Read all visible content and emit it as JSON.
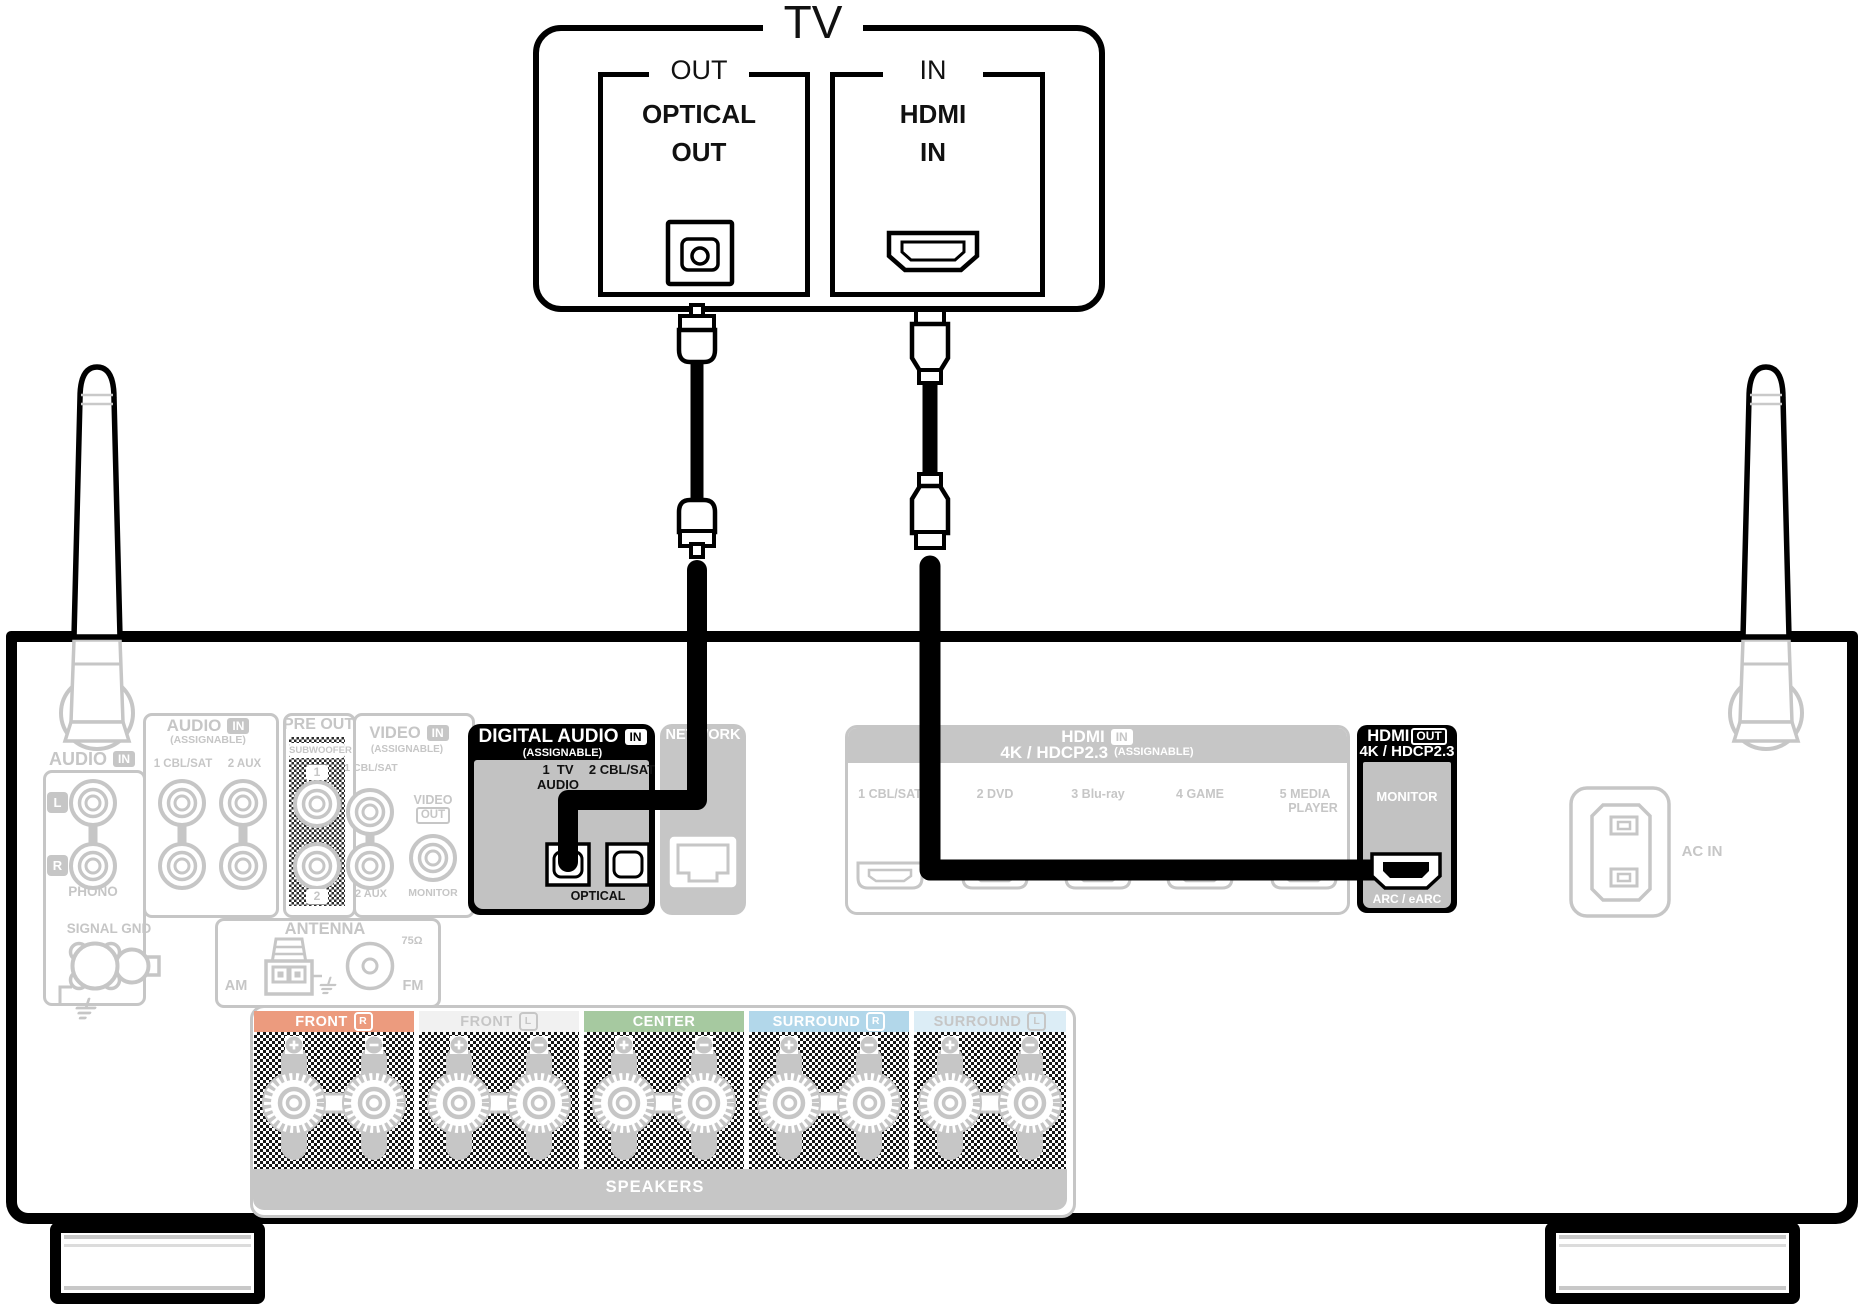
{
  "tv": {
    "title": "TV",
    "optical_box": {
      "tab": "OUT",
      "line1": "OPTICAL",
      "line2": "OUT"
    },
    "hdmi_box": {
      "tab": "IN",
      "line1": "HDMI",
      "line2": "IN"
    }
  },
  "receiver": {
    "audio_phono": {
      "title": "AUDIO",
      "badge": "IN",
      "left": "L",
      "right": "R",
      "caption": "PHONO"
    },
    "audio_assignable": {
      "title": "AUDIO",
      "badge": "IN",
      "subtitle": "(ASSIGNABLE)",
      "input1": "1 CBL/SAT",
      "input2": "2 AUX"
    },
    "pre_out": {
      "title": "PRE OUT",
      "caption": "SUBWOOFER",
      "jack1": "1",
      "jack2": "2"
    },
    "video": {
      "title": "VIDEO",
      "badge": "IN",
      "subtitle": "(ASSIGNABLE)",
      "input1": "1 CBL/SAT",
      "input2": "2 AUX",
      "out_title": "VIDEO",
      "out_badge": "OUT",
      "out_caption": "MONITOR"
    },
    "digital_audio": {
      "title": "DIGITAL AUDIO",
      "badge": "IN",
      "subtitle": "(ASSIGNABLE)",
      "input1_line1": "1  TV",
      "input1_line2": "AUDIO",
      "input2": "2 CBL/SAT",
      "caption": "OPTICAL"
    },
    "network": {
      "title": "NETWORK"
    },
    "hdmi_in": {
      "title": "HDMI",
      "badge": "IN",
      "line2": "4K / HDCP2.3",
      "subtitle": "(ASSIGNABLE)",
      "ports": [
        {
          "label": "1 CBL/SAT"
        },
        {
          "label": "2 DVD"
        },
        {
          "label": "3 Blu-ray"
        },
        {
          "label": "4 GAME"
        },
        {
          "label": "5 MEDIA",
          "label2": "PLAYER"
        }
      ]
    },
    "hdmi_out": {
      "title": "HDMI",
      "badge": "OUT",
      "line2": "4K / HDCP2.3",
      "monitor": "MONITOR",
      "arc": "ARC / eARC"
    },
    "ac_in": {
      "label": "AC IN"
    },
    "signal_gnd": {
      "label": "SIGNAL GND"
    },
    "antenna": {
      "title": "ANTENNA",
      "am": "AM",
      "fm": "FM",
      "ohm": "75Ω"
    },
    "speakers": {
      "title": "SPEAKERS",
      "channels": [
        {
          "label": "FRONT",
          "chip": "R",
          "band_color": "#ec9b7e",
          "text_color": "#ffffff"
        },
        {
          "label": "FRONT",
          "chip": "L",
          "band_color": "#f1f1f1",
          "text_color": "#c6c6c6"
        },
        {
          "label": "CENTER",
          "chip": "",
          "band_color": "#a6c9a0",
          "text_color": "#ffffff"
        },
        {
          "label": "SURROUND",
          "chip": "R",
          "band_color": "#b2d7ea",
          "text_color": "#ffffff"
        },
        {
          "label": "SURROUND",
          "chip": "L",
          "band_color": "#dcedf6",
          "text_color": "#c6c6c6"
        }
      ]
    }
  },
  "colors": {
    "highlight": "#000000",
    "grayed_out": "#c6c6c6",
    "cable": "#000000"
  }
}
